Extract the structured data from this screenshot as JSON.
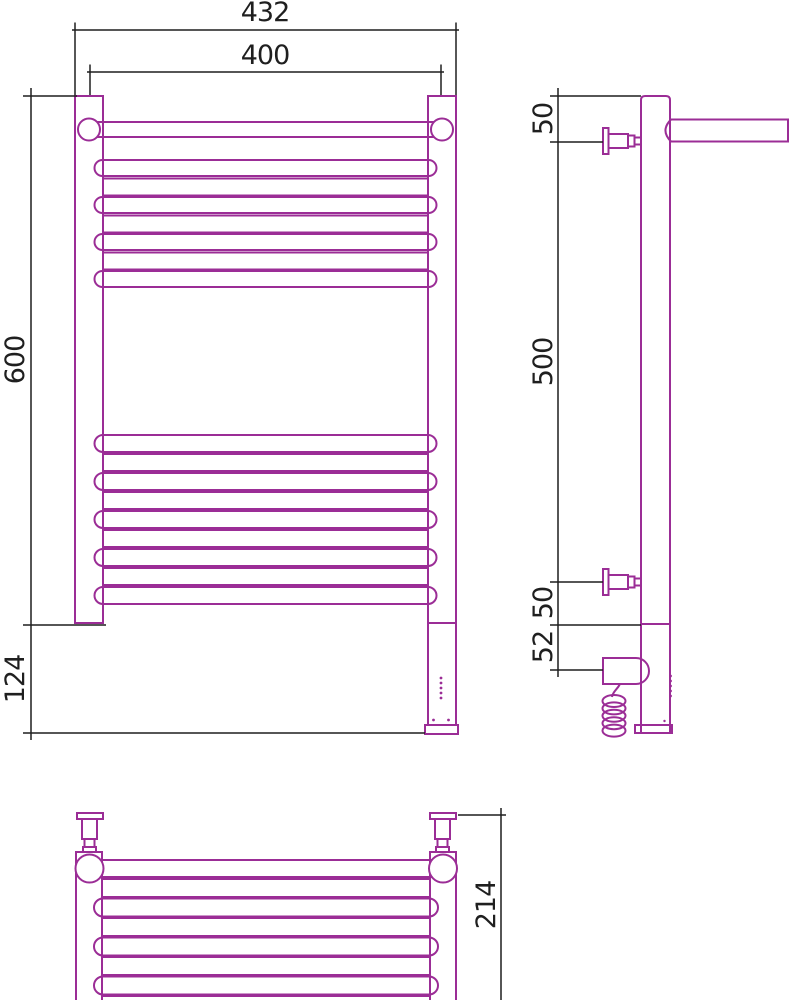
{
  "colors": {
    "product": "#9b2d96",
    "dimension": "#1f1f1f",
    "background": "#ffffff"
  },
  "front_view": {
    "overall_width": "432",
    "rail_axis_width": "400",
    "body_height": "600",
    "heater_extension": "124",
    "top_crossbar_count": 7,
    "bottom_crossbar_count": 9,
    "indicator_dot_count": 5
  },
  "side_view": {
    "top_bracket_offset": "50",
    "bracket_span": "500",
    "bottom_bracket_offset": "50",
    "heater_offset": "52",
    "cord_loop_count": 5
  },
  "top_view": {
    "depth": "214",
    "crossbar_count": 7
  }
}
